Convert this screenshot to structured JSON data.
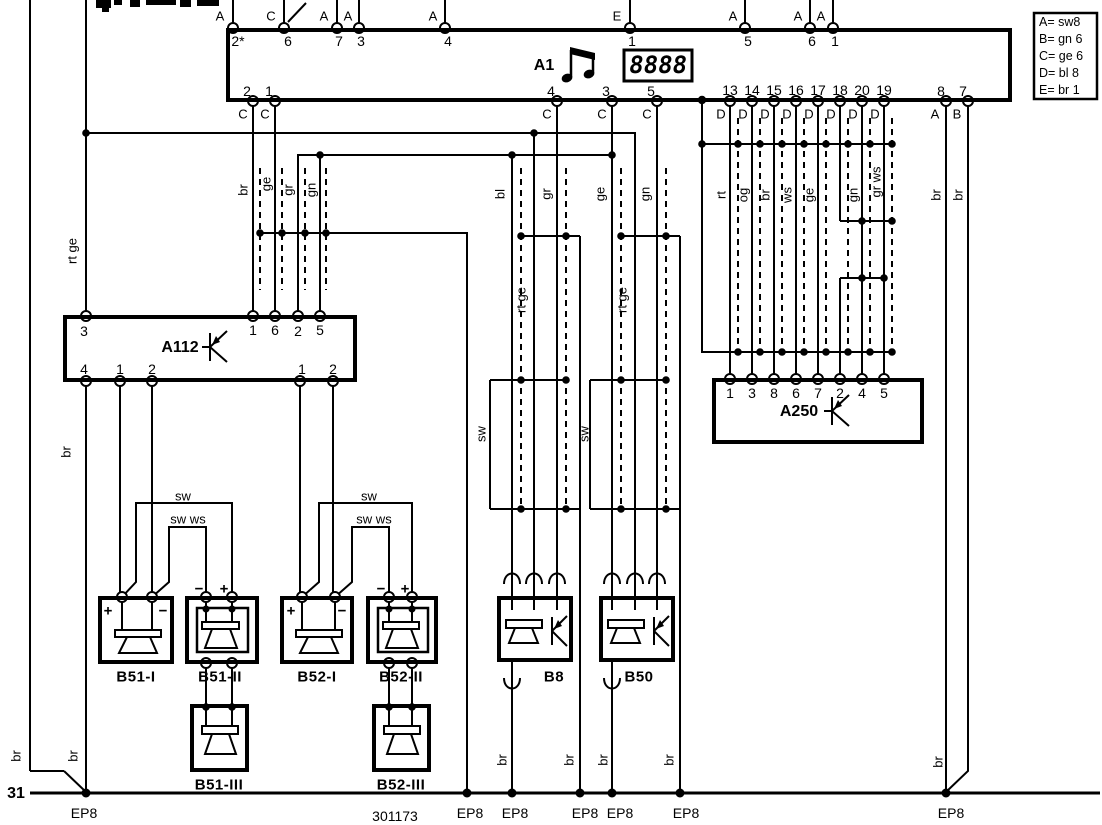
{
  "diagram": {
    "components": {
      "a1": {
        "label": "A1",
        "display_value": "8888"
      },
      "a112": {
        "label": "A112"
      },
      "a250": {
        "label": "A250"
      }
    },
    "ground": {
      "terminal": "31",
      "part_number": "301173",
      "ground_label": "EP8"
    },
    "legend_rows": [
      "A= sw8",
      "B= gn 6",
      "C= ge 6",
      "D= bl 8",
      "E= br 1"
    ]
  },
  "labels": {
    "pin_numbers": [
      {
        "t": "2*",
        "x": 238,
        "y": 41
      },
      {
        "t": "6",
        "x": 288,
        "y": 41
      },
      {
        "t": "7",
        "x": 339,
        "y": 41
      },
      {
        "t": "3",
        "x": 361,
        "y": 41
      },
      {
        "t": "4",
        "x": 448,
        "y": 41
      },
      {
        "t": "1",
        "x": 632,
        "y": 41
      },
      {
        "t": "5",
        "x": 748,
        "y": 41
      },
      {
        "t": "6",
        "x": 812,
        "y": 41
      },
      {
        "t": "1",
        "x": 835,
        "y": 41
      },
      {
        "t": "2",
        "x": 247,
        "y": 91
      },
      {
        "t": "1",
        "x": 269,
        "y": 91
      },
      {
        "t": "4",
        "x": 551,
        "y": 91
      },
      {
        "t": "3",
        "x": 606,
        "y": 91
      },
      {
        "t": "5",
        "x": 651,
        "y": 91
      },
      {
        "t": "13",
        "x": 730,
        "y": 90
      },
      {
        "t": "14",
        "x": 752,
        "y": 90
      },
      {
        "t": "15",
        "x": 774,
        "y": 90
      },
      {
        "t": "16",
        "x": 796,
        "y": 90
      },
      {
        "t": "17",
        "x": 818,
        "y": 90
      },
      {
        "t": "18",
        "x": 840,
        "y": 90
      },
      {
        "t": "20",
        "x": 862,
        "y": 90
      },
      {
        "t": "19",
        "x": 884,
        "y": 90
      },
      {
        "t": "8",
        "x": 941,
        "y": 91
      },
      {
        "t": "7",
        "x": 963,
        "y": 91
      },
      {
        "t": "3",
        "x": 84,
        "y": 331
      },
      {
        "t": "1",
        "x": 253,
        "y": 330
      },
      {
        "t": "6",
        "x": 275,
        "y": 330
      },
      {
        "t": "2",
        "x": 298,
        "y": 331
      },
      {
        "t": "5",
        "x": 320,
        "y": 330
      },
      {
        "t": "4",
        "x": 84,
        "y": 369
      },
      {
        "t": "1",
        "x": 120,
        "y": 369
      },
      {
        "t": "2",
        "x": 152,
        "y": 369
      },
      {
        "t": "1",
        "x": 302,
        "y": 369
      },
      {
        "t": "2",
        "x": 333,
        "y": 369
      },
      {
        "t": "1",
        "x": 730,
        "y": 393
      },
      {
        "t": "3",
        "x": 752,
        "y": 393
      },
      {
        "t": "8",
        "x": 774,
        "y": 393
      },
      {
        "t": "6",
        "x": 796,
        "y": 393
      },
      {
        "t": "7",
        "x": 818,
        "y": 393
      },
      {
        "t": "2",
        "x": 840,
        "y": 393
      },
      {
        "t": "4",
        "x": 862,
        "y": 393
      },
      {
        "t": "5",
        "x": 884,
        "y": 393
      }
    ],
    "pin_letters": [
      {
        "t": "A",
        "x": 220,
        "y": 16
      },
      {
        "t": "C",
        "x": 271,
        "y": 16
      },
      {
        "t": "A",
        "x": 324,
        "y": 16
      },
      {
        "t": "A",
        "x": 348,
        "y": 16
      },
      {
        "t": "A",
        "x": 433,
        "y": 16
      },
      {
        "t": "E",
        "x": 617,
        "y": 16
      },
      {
        "t": "A",
        "x": 733,
        "y": 16
      },
      {
        "t": "A",
        "x": 798,
        "y": 16
      },
      {
        "t": "A",
        "x": 821,
        "y": 16
      },
      {
        "t": "C",
        "x": 243,
        "y": 114
      },
      {
        "t": "C",
        "x": 265,
        "y": 114
      },
      {
        "t": "C",
        "x": 547,
        "y": 114
      },
      {
        "t": "C",
        "x": 602,
        "y": 114
      },
      {
        "t": "C",
        "x": 647,
        "y": 114
      },
      {
        "t": "D",
        "x": 721,
        "y": 114
      },
      {
        "t": "D",
        "x": 743,
        "y": 114
      },
      {
        "t": "D",
        "x": 765,
        "y": 114
      },
      {
        "t": "D",
        "x": 787,
        "y": 114
      },
      {
        "t": "D",
        "x": 809,
        "y": 114
      },
      {
        "t": "D",
        "x": 831,
        "y": 114
      },
      {
        "t": "D",
        "x": 853,
        "y": 114
      },
      {
        "t": "D",
        "x": 875,
        "y": 114
      },
      {
        "t": "A",
        "x": 935,
        "y": 114
      },
      {
        "t": "B",
        "x": 957,
        "y": 114
      }
    ],
    "wire_labels": [
      {
        "t": "br",
        "x": 243,
        "y": 190,
        "r": 1
      },
      {
        "t": "ge",
        "x": 266,
        "y": 184,
        "r": 1
      },
      {
        "t": "gr",
        "x": 288,
        "y": 190,
        "r": 1
      },
      {
        "t": "gn",
        "x": 311,
        "y": 190,
        "r": 1
      },
      {
        "t": "rt ge",
        "x": 72,
        "y": 251,
        "r": 1
      },
      {
        "t": "br",
        "x": 66,
        "y": 452,
        "r": 1
      },
      {
        "t": "bl",
        "x": 500,
        "y": 194,
        "r": 1
      },
      {
        "t": "gr",
        "x": 546,
        "y": 194,
        "r": 1
      },
      {
        "t": "ge",
        "x": 600,
        "y": 194,
        "r": 1
      },
      {
        "t": "gn",
        "x": 645,
        "y": 194,
        "r": 1
      },
      {
        "t": "rt ge",
        "x": 521,
        "y": 300,
        "r": 1
      },
      {
        "t": "rt ge",
        "x": 622,
        "y": 300,
        "r": 1
      },
      {
        "t": "sw",
        "x": 481,
        "y": 434,
        "r": 1
      },
      {
        "t": "sw",
        "x": 584,
        "y": 434,
        "r": 1
      },
      {
        "t": "rt",
        "x": 721,
        "y": 195,
        "r": 1
      },
      {
        "t": "og",
        "x": 743,
        "y": 195,
        "r": 1
      },
      {
        "t": "br",
        "x": 765,
        "y": 195,
        "r": 1
      },
      {
        "t": "ws",
        "x": 787,
        "y": 195,
        "r": 1
      },
      {
        "t": "ge",
        "x": 809,
        "y": 195,
        "r": 1
      },
      {
        "t": "gn",
        "x": 853,
        "y": 195,
        "r": 1
      },
      {
        "t": "gr ws",
        "x": 876,
        "y": 182,
        "r": 1
      },
      {
        "t": "br",
        "x": 936,
        "y": 195,
        "r": 1
      },
      {
        "t": "br",
        "x": 958,
        "y": 195,
        "r": 1
      },
      {
        "t": "br",
        "x": 16,
        "y": 756,
        "r": 1
      },
      {
        "t": "br",
        "x": 73,
        "y": 756,
        "r": 1
      },
      {
        "t": "br",
        "x": 502,
        "y": 760,
        "r": 1
      },
      {
        "t": "br",
        "x": 569,
        "y": 760,
        "r": 1
      },
      {
        "t": "br",
        "x": 603,
        "y": 760,
        "r": 1
      },
      {
        "t": "br",
        "x": 669,
        "y": 760,
        "r": 1
      },
      {
        "t": "br",
        "x": 938,
        "y": 762,
        "r": 1
      },
      {
        "t": "sw",
        "x": 183,
        "y": 496
      },
      {
        "t": "sw ws",
        "x": 188,
        "y": 519
      },
      {
        "t": "sw",
        "x": 369,
        "y": 496
      },
      {
        "t": "sw ws",
        "x": 374,
        "y": 519
      }
    ],
    "box_labels": [
      {
        "t": "B51-I",
        "x": 136,
        "y": 677
      },
      {
        "t": "B51-II",
        "x": 220,
        "y": 677
      },
      {
        "t": "B52-I",
        "x": 317,
        "y": 677
      },
      {
        "t": "B52-II",
        "x": 401,
        "y": 677
      },
      {
        "t": "B8",
        "x": 554,
        "y": 677
      },
      {
        "t": "B50",
        "x": 639,
        "y": 677
      },
      {
        "t": "B51-III",
        "x": 219,
        "y": 785
      },
      {
        "t": "B52-III",
        "x": 401,
        "y": 785
      }
    ],
    "polarity": [
      {
        "t": "+",
        "x": 108,
        "y": 611
      },
      {
        "t": "−",
        "x": 163,
        "y": 611
      },
      {
        "t": "+",
        "x": 291,
        "y": 611
      },
      {
        "t": "−",
        "x": 342,
        "y": 611
      },
      {
        "t": "−",
        "x": 199,
        "y": 589
      },
      {
        "t": "+",
        "x": 224,
        "y": 589
      },
      {
        "t": "−",
        "x": 381,
        "y": 589
      },
      {
        "t": "+",
        "x": 405,
        "y": 589
      }
    ],
    "ground_points": [
      {
        "t": "EP8",
        "x": 84,
        "y": 813
      },
      {
        "t": "EP8",
        "x": 470,
        "y": 813
      },
      {
        "t": "EP8",
        "x": 515,
        "y": 813
      },
      {
        "t": "EP8",
        "x": 585,
        "y": 813
      },
      {
        "t": "EP8",
        "x": 620,
        "y": 813
      },
      {
        "t": "EP8",
        "x": 686,
        "y": 813
      },
      {
        "t": "EP8",
        "x": 951,
        "y": 813
      }
    ]
  }
}
